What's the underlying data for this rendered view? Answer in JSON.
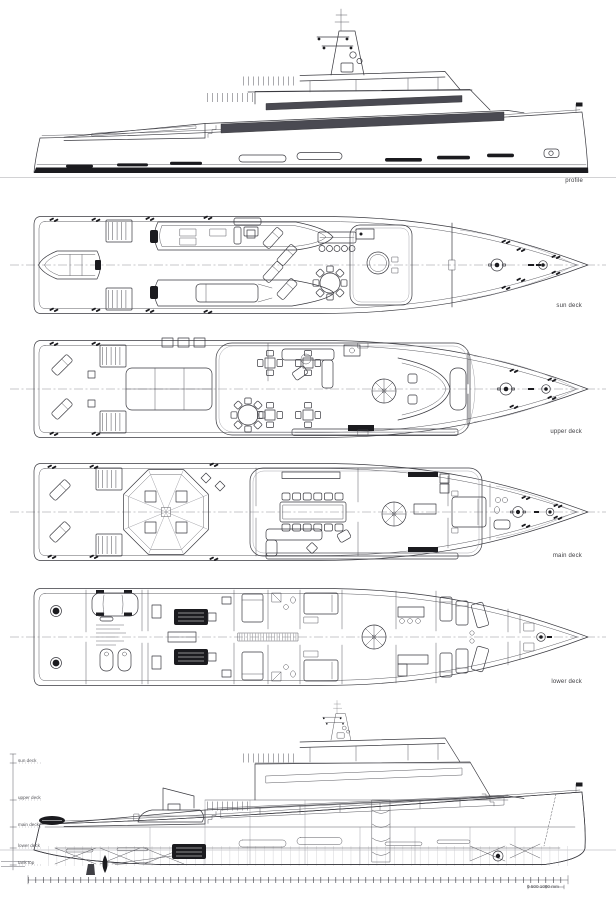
{
  "labels": {
    "profile": "profile",
    "sun_deck": "sun deck",
    "upper_deck": "upper deck",
    "main_deck": "main deck",
    "lower_deck": "lower deck"
  },
  "arrangement_profile": {
    "deck_levels": [
      "sun deck",
      "upper deck",
      "main deck",
      "lower deck",
      "tank top"
    ],
    "scale_label": "0    500   1000 mm"
  },
  "colors": {
    "paper": "#ffffff",
    "ink": "#3a3a40",
    "glass_band": "#4a4a52",
    "dark_fill": "#1b1b1f",
    "faint_line": "#9a9aa0"
  }
}
